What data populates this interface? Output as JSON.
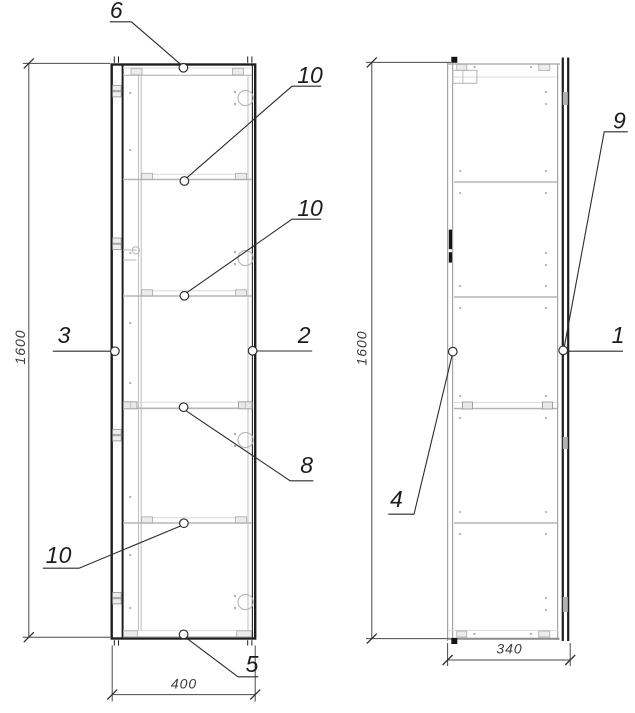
{
  "drawing": {
    "type": "furniture-cabinet-technical-drawing",
    "views": {
      "front": "front-view",
      "side": "side-view"
    }
  },
  "callouts": {
    "front": {
      "top": "6",
      "upper_shelf": "10",
      "middle_shelf": "10",
      "left_side": "3",
      "right_side": "2",
      "fixed_shelf": "8",
      "lower_shelf": "10",
      "bottom": "5"
    },
    "side": {
      "door_edge_top": "9",
      "door_edge": "1",
      "back_panel": "4"
    }
  },
  "dimensions": {
    "front_height": "1600",
    "front_width": "400",
    "side_height": "1600",
    "side_depth": "340"
  },
  "colors": {
    "background": "#ffffff",
    "outline": "#1f1f1f",
    "carcass_gray": "#a5a5a5",
    "detail_gray": "#b5b5b5",
    "dimension_line": "#4a4a4a",
    "leader": "#2b2b2b",
    "text": "#1c1c1c",
    "dim_text": "#3c3c3c"
  }
}
